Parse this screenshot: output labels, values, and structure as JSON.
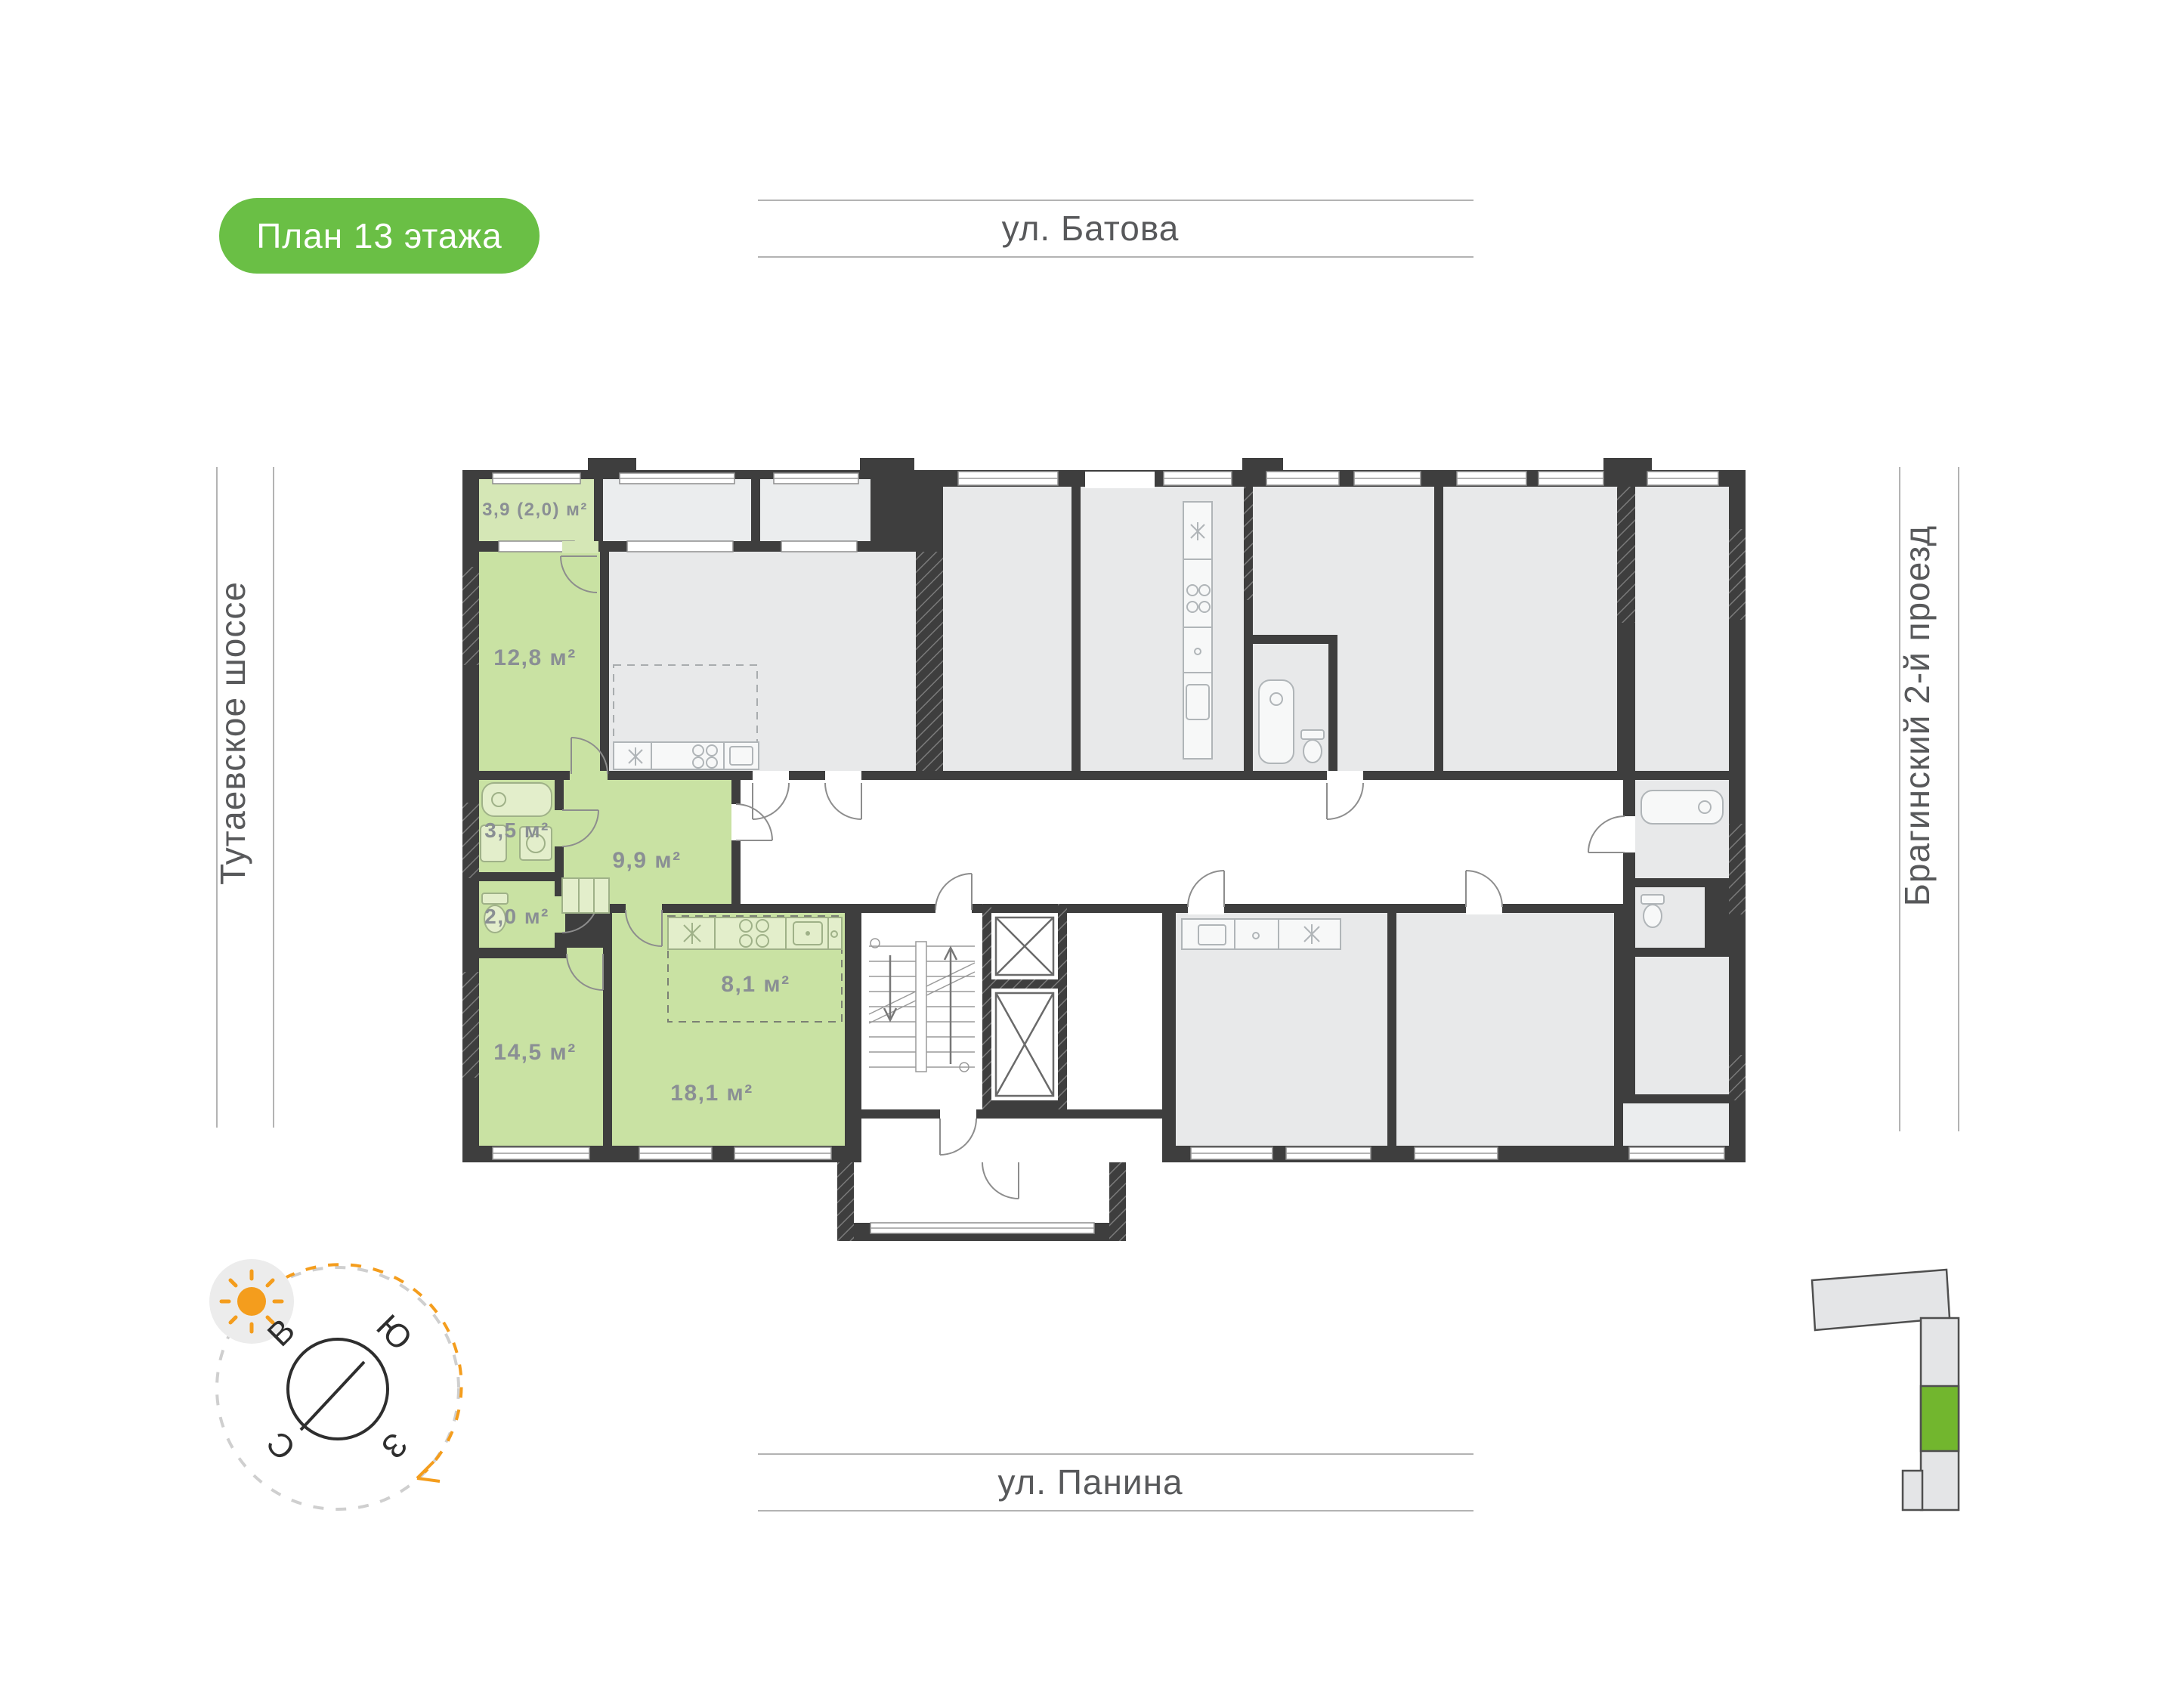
{
  "badge": {
    "label": "План 13 этажа"
  },
  "streets": {
    "top": "ул. Батова",
    "bottom": "ул. Панина",
    "left": "Тутаевское шоссе",
    "right": "Брагинский 2-й проезд"
  },
  "compass": {
    "east": "В",
    "south": "Ю",
    "west": "З",
    "north": "С"
  },
  "apartment": {
    "highlighted": true,
    "rooms": [
      {
        "name": "balcony",
        "area": "3,9 (2,0) м²"
      },
      {
        "name": "bedroom-1",
        "area": "12,8 м²"
      },
      {
        "name": "bathroom",
        "area": "3,5 м²"
      },
      {
        "name": "wc",
        "area": "2,0 м²"
      },
      {
        "name": "hallway",
        "area": "9,9 м²"
      },
      {
        "name": "bedroom-2",
        "area": "14,5 м²"
      },
      {
        "name": "kitchen-zone",
        "area": "8,1 м²"
      },
      {
        "name": "living-kitchen",
        "area": "18,1 м²"
      }
    ]
  },
  "colors": {
    "accent_green": "#6abf45",
    "room_green": "#c9e2a3",
    "minimap_green": "#72b62e",
    "sun_orange": "#f49d1d",
    "wall_dark": "#3e3e3e",
    "room_gray": "#e8e9ea"
  }
}
